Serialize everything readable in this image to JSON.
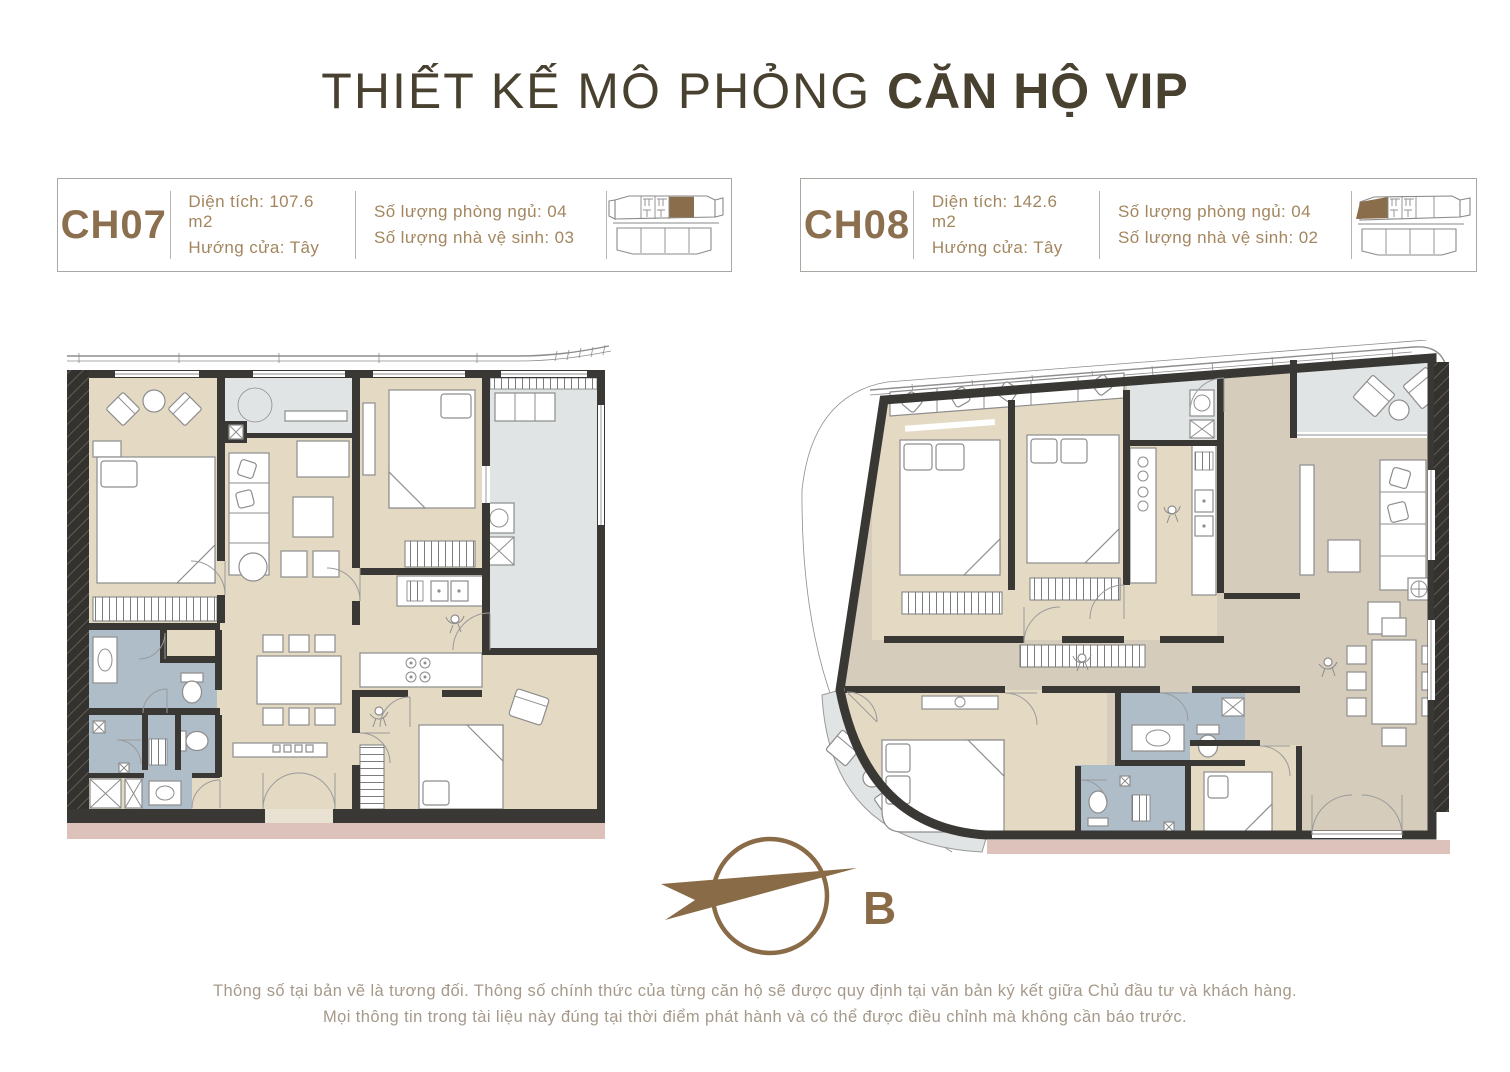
{
  "title": {
    "prefix": "THIẾT KẾ MÔ PHỎNG ",
    "highlight": "CĂN HỘ VIP"
  },
  "units": [
    {
      "code": "CH07",
      "area": "Diện tích: 107.6 m2",
      "door_direction": "Hướng cửa: Tây",
      "bedrooms": "Số lượng phòng ngủ: 04",
      "bathrooms": "Số lượng nhà vệ sinh: 03"
    },
    {
      "code": "CH08",
      "area": "Diện tích: 142.6 m2",
      "door_direction": "Hướng cửa: Tây",
      "bedrooms": "Số lượng phòng ngủ: 04",
      "bathrooms": "Số lượng nhà vệ sinh: 02"
    }
  ],
  "compass": {
    "label": "B"
  },
  "footer": {
    "line1": "Thông số tại bản vẽ là tương đối. Thông số chính thức của từng căn hộ sẽ được quy định tại văn bản ký kết giữa Chủ đầu tư và khách hàng.",
    "line2": "Mọi thông tin trong tài liệu này đúng tại thời điểm phát hành và có thể được điều chỉnh mà không cần báo trước."
  },
  "colors": {
    "accent_brown": "#8c6f4e",
    "title_brown": "#48412f",
    "wall": "#3a3835",
    "room_beige": "#e4dac4",
    "room_tan": "#d5ccbc",
    "bathroom_blue": "#aebdc8",
    "balcony_gray": "#e0e4e5",
    "base_pink": "#dcc2ba"
  }
}
